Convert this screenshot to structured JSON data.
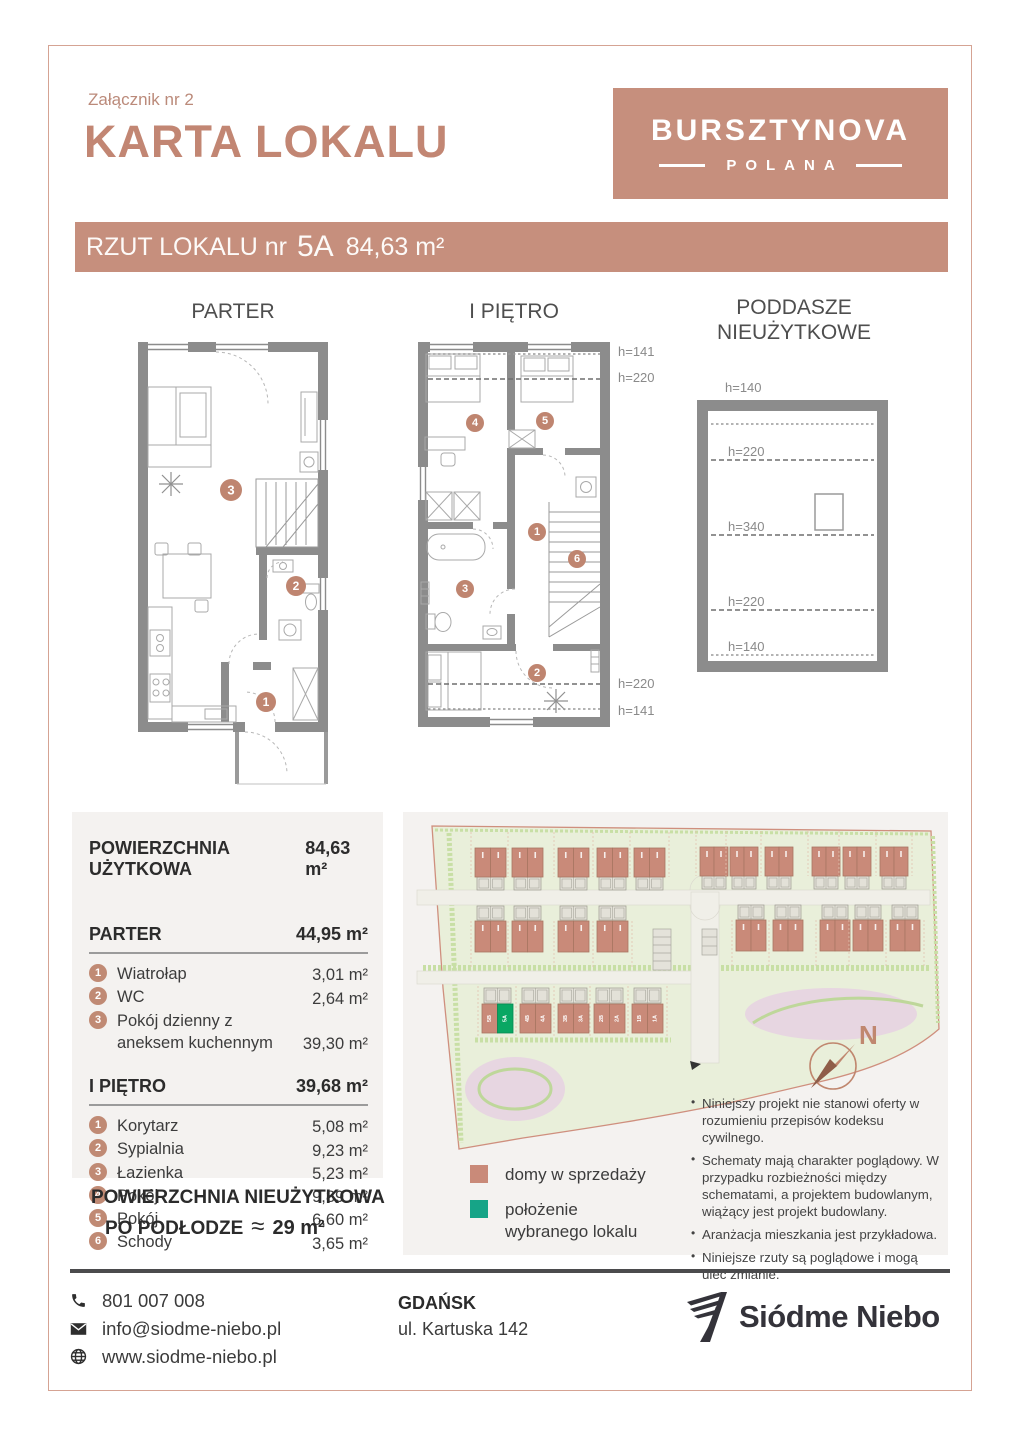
{
  "header": {
    "attachment": "Załącznik nr 2",
    "title": "KARTA LOKALU",
    "logo_line1": "BURSZTYNOVA",
    "logo_line2": "POLANA"
  },
  "banner": {
    "prefix": "RZUT LOKALU nr",
    "unit": "5A",
    "area": "84,63 m²"
  },
  "plans": {
    "parter": {
      "title": "PARTER",
      "circles": [
        "1",
        "2",
        "3"
      ]
    },
    "pietro": {
      "title": "I PIĘTRO",
      "circles": [
        "1",
        "2",
        "3",
        "4",
        "5",
        "6"
      ],
      "h_top_1": "h=141",
      "h_top_2": "h=220",
      "h_bottom_1": "h=220",
      "h_bottom_2": "h=141"
    },
    "poddasze": {
      "title_line1": "PODDASZE",
      "title_line2": "NIEUŻYTKOWE",
      "h_above": "h=140",
      "h_1": "h=220",
      "h_2": "h=340",
      "h_3": "h=220",
      "h_4": "h=140"
    }
  },
  "areas": {
    "total_label": "POWIERZCHNIA UŻYTKOWA",
    "total_value": "84,63 m²",
    "sections": [
      {
        "label": "PARTER",
        "value": "44,95 m²",
        "items": [
          {
            "num": "1",
            "label": "Wiatrołap",
            "value": "3,01 m²"
          },
          {
            "num": "2",
            "label": "WC",
            "value": "2,64 m²"
          },
          {
            "num": "3",
            "label": "Pokój dzienny z aneksem kuchennym",
            "value": "39,30 m²"
          }
        ]
      },
      {
        "label": "I PIĘTRO",
        "value": "39,68 m²",
        "items": [
          {
            "num": "1",
            "label": "Korytarz",
            "value": "5,08 m²"
          },
          {
            "num": "2",
            "label": "Sypialnia",
            "value": "9,23 m²"
          },
          {
            "num": "3",
            "label": "Łazienka",
            "value": "5,23 m²"
          },
          {
            "num": "4",
            "label": "Pokój",
            "value": "9,89 m²"
          },
          {
            "num": "5",
            "label": "Pokój",
            "value": "6,60 m²"
          },
          {
            "num": "6",
            "label": "Schody",
            "value": "3,65 m²"
          }
        ]
      }
    ],
    "unused_label_1": "POWIERZCHNIA NIEUŻYTKOWA",
    "unused_label_2": "PO PODŁODZE",
    "unused_approx": "≈",
    "unused_value": "29 m²"
  },
  "map": {
    "north_label": "N",
    "colors": {
      "building_fill": "#c98a79",
      "building_stroke": "#a97662",
      "garage_fill": "#e3e1d8",
      "garage_stroke": "#9b9a90",
      "highlight": "#09a763",
      "highlight_stroke": "#058a52",
      "plot_line": "#e3c2b0"
    },
    "rows": [
      {
        "x": [
          72,
          109,
          155,
          194,
          231
        ],
        "w": 31,
        "y": 30,
        "h": 29,
        "gy": 59,
        "gh": 13,
        "plot": [
          14,
          59
        ]
      },
      {
        "x": [
          297,
          327,
          362,
          409,
          440,
          477
        ],
        "w": 28,
        "y": 29,
        "h": 29,
        "gy": 58,
        "gh": 13,
        "plot": [
          13,
          58
        ]
      },
      {
        "x": [
          72,
          109,
          155,
          194
        ],
        "w": 31,
        "y": 103,
        "h": 31,
        "gy": 88,
        "gh": 14,
        "plot": [
          103,
          150
        ]
      },
      {
        "x": [
          333,
          370,
          417,
          450,
          487
        ],
        "w": 30,
        "y": 102,
        "h": 31,
        "gy": 87,
        "gh": 14,
        "plot": [
          102,
          148
        ]
      },
      {
        "x": [
          79,
          117,
          155,
          191,
          229
        ],
        "w": 31,
        "y": 186,
        "h": 29,
        "gy": 170,
        "gh": 15,
        "plot": [
          168,
          218
        ],
        "labels": [
          [
            "5B",
            "5A"
          ],
          [
            "4B",
            "4A"
          ],
          [
            "3B",
            "3A"
          ],
          [
            "2B",
            "2A"
          ],
          [
            "1B",
            "1A"
          ]
        ],
        "highlight": {
          "building": 0,
          "half": 1
        }
      }
    ]
  },
  "legend": {
    "items": [
      {
        "color": "#c98a79",
        "label": "domy w sprzedaży"
      },
      {
        "color": "#16a487",
        "label": "położenie wybranego lokalu"
      }
    ]
  },
  "disclaimers": [
    "Niniejszy projekt nie stanowi oferty w rozumieniu przepisów kodeksu cywilnego.",
    "Schematy mają charakter poglądowy. W przypadku rozbieżności między schematami, a projektem budowlanym, wiążący jest projekt budowlany.",
    "Aranżacja mieszkania jest przykładowa.",
    "Niniejsze rzuty są poglądowe i mogą ulec zmianie."
  ],
  "footer": {
    "phone": "801 007 008",
    "email": "info@siodme-niebo.pl",
    "website": "www.siodme-niebo.pl",
    "city": "GDAŃSK",
    "address": "ul. Kartuska 142",
    "brand": "Siódme Niebo"
  }
}
